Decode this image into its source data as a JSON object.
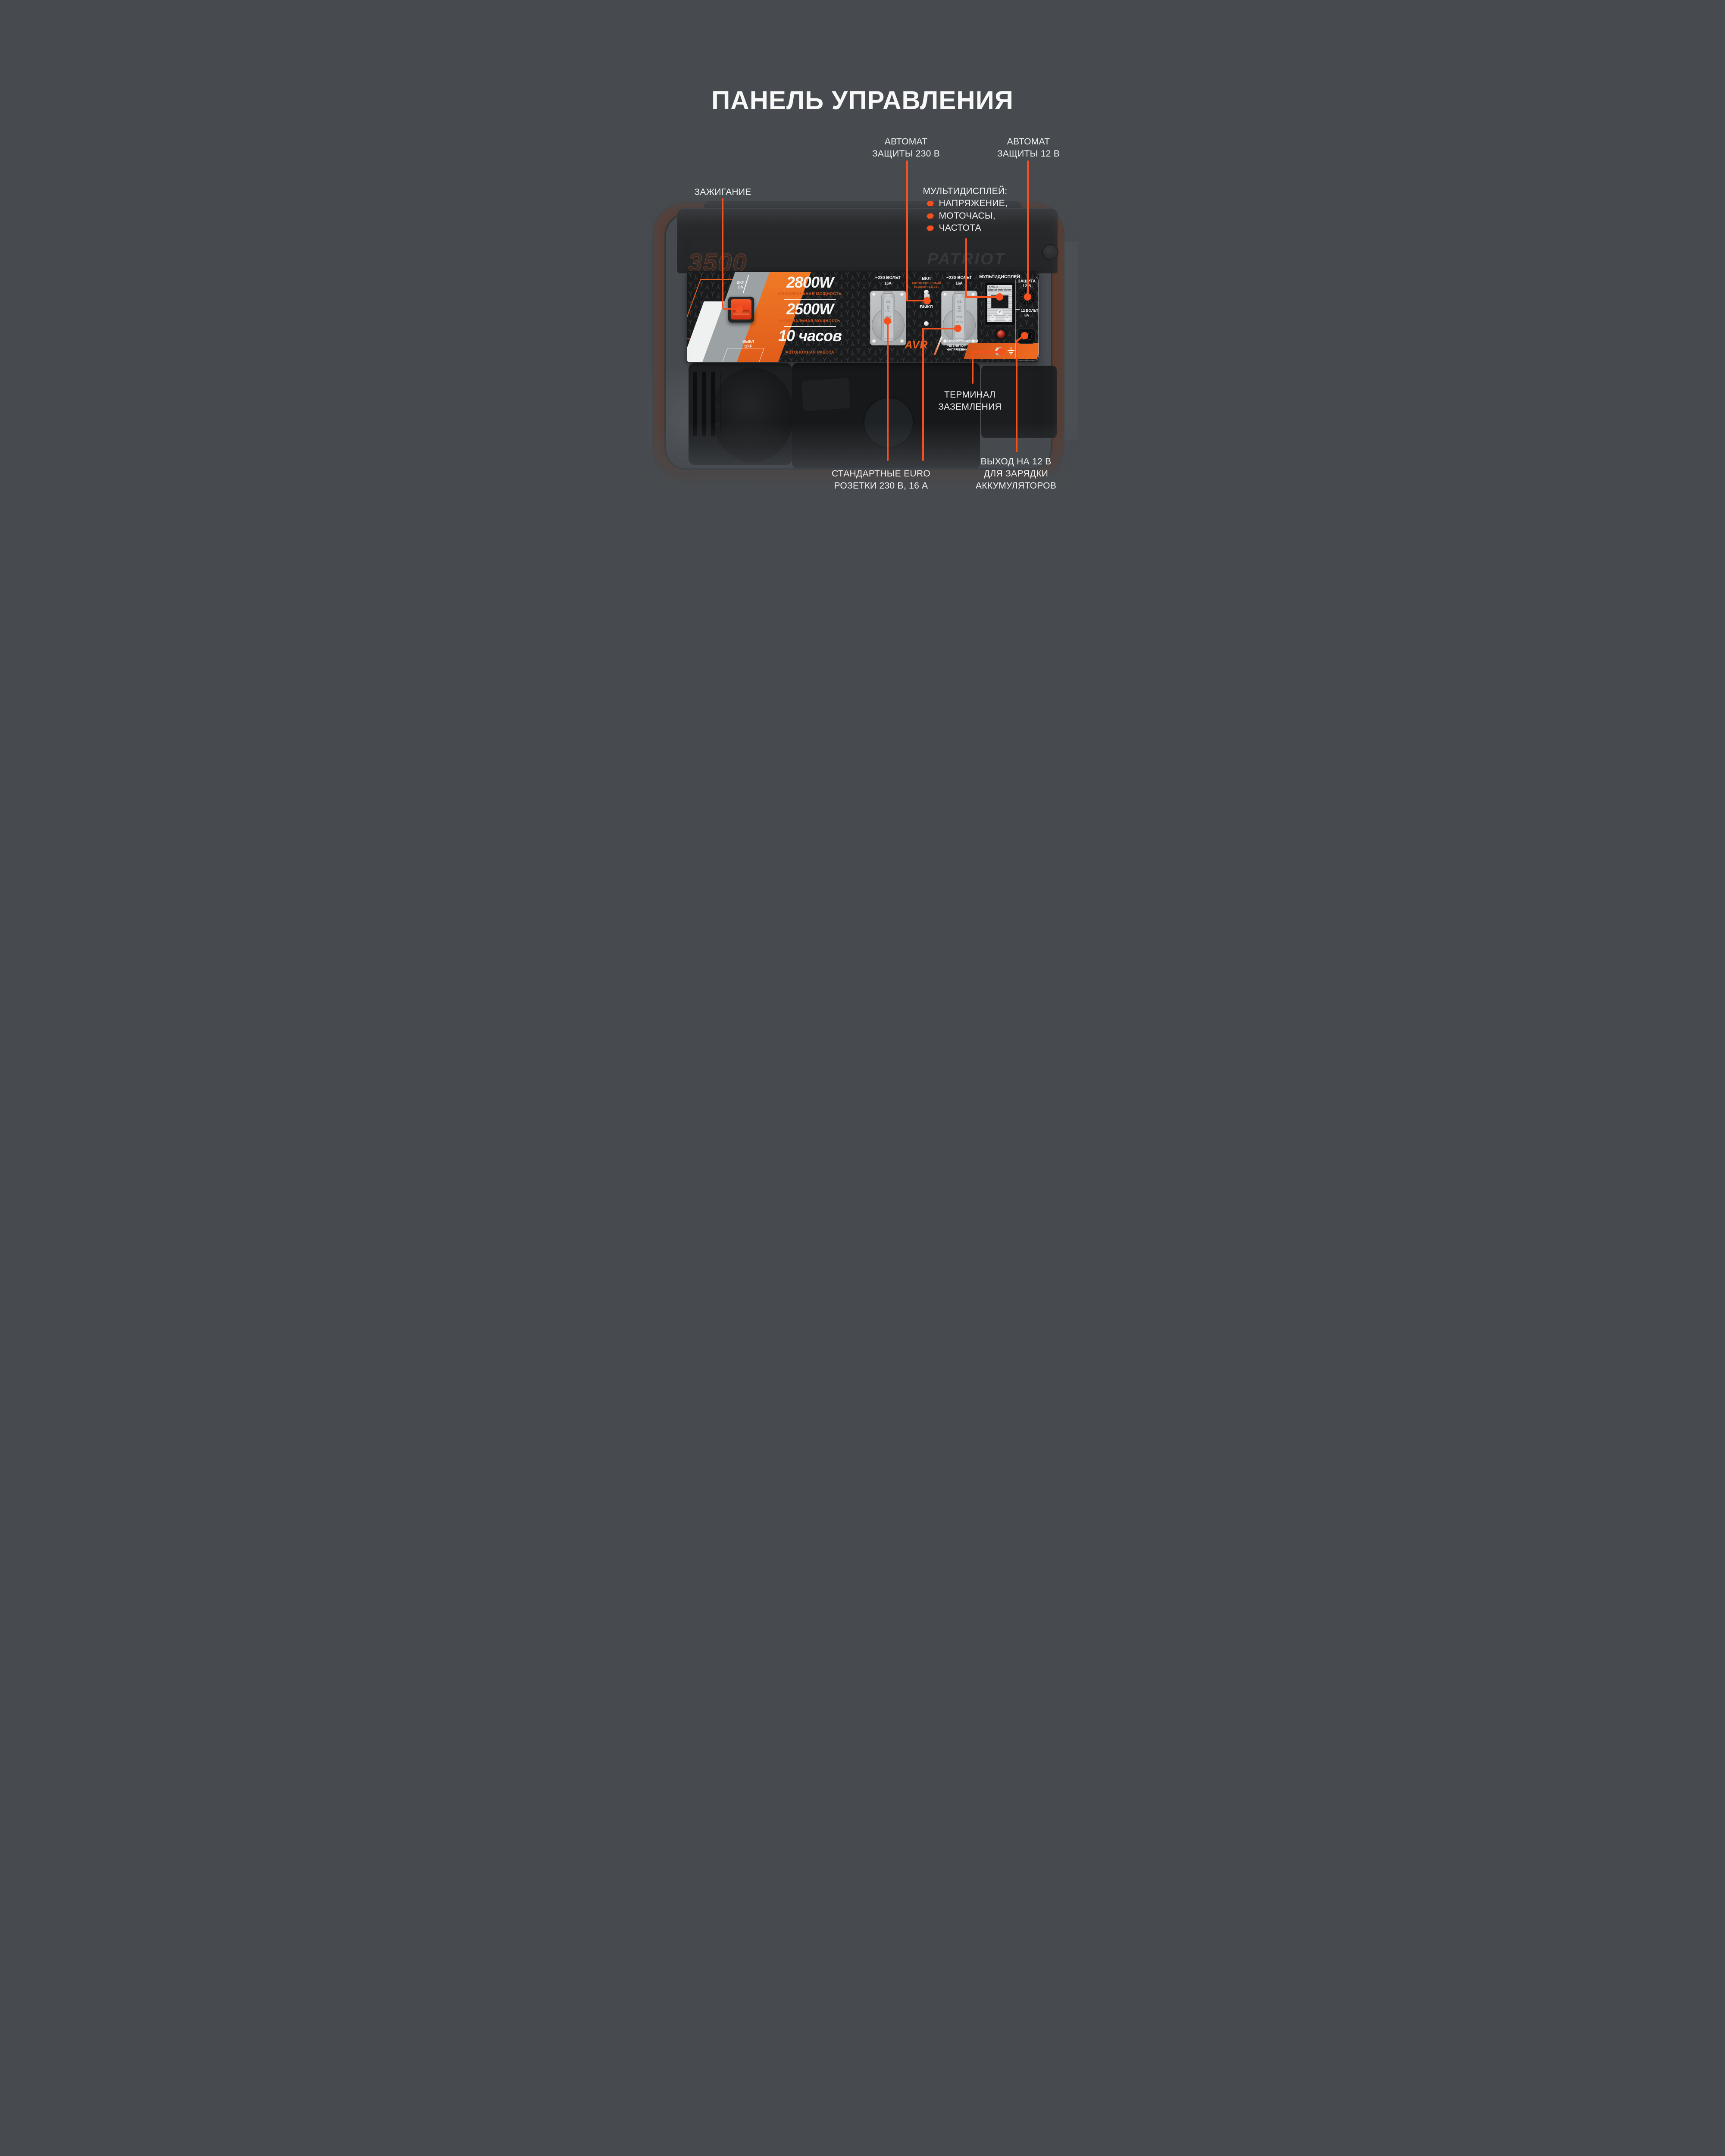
{
  "title": "ПАНЕЛЬ УПРАВЛЕНИЯ",
  "colors": {
    "background": "#474B4F",
    "accent": "#F4511E",
    "panel_orange": "#E8621F",
    "caption_orange": "#D4581E",
    "rocker_red": "#E8431F"
  },
  "callouts": {
    "breaker230": {
      "line1": "АВТОМАТ",
      "line2": "ЗАЩИТЫ 230 В"
    },
    "breaker12": {
      "line1": "АВТОМАТ",
      "line2": "ЗАЩИТЫ 12 В"
    },
    "ignition": {
      "line1": "ЗАЖИГАНИЕ"
    },
    "multidisplay": {
      "heading": "МУЛЬТИДИСПЛЕЙ:",
      "items": [
        "НАПРЯЖЕНИЕ,",
        "МОТОЧАСЫ,",
        "ЧАСТОТА"
      ]
    },
    "ground": {
      "line1": "ТЕРМИНАЛ",
      "line2": "ЗАЗЕМЛЕНИЯ"
    },
    "euro_sockets": {
      "line1": "СТАНДАРТНЫЕ EURO",
      "line2": "РОЗЕТКИ 230 В, 16 А"
    },
    "out12": {
      "line1": "ВЫХОД НА 12 В",
      "line2": "ДЛЯ ЗАРЯДКИ",
      "line3": "АККУМУЛЯТОРОВ"
    }
  },
  "generator": {
    "brand": "PATRIOT",
    "model": "3500"
  },
  "panel": {
    "ignition_switch": {
      "on_ru": "ВКЛ",
      "on_en": "ON",
      "off_ru": "ВЫКЛ",
      "off_en": "OFF"
    },
    "specs": {
      "max_value": "2800W",
      "max_label": "МАКСИМАЛЬНАЯ МОЩНОСТЬ",
      "nom_value": "2500W",
      "nom_label": "НОМИНАЛЬНАЯ МОЩНОСТЬ",
      "run_value": "10 часов",
      "run_label": "АВТОНОМНАЯ РАБОТА"
    },
    "socket": {
      "volts": "~230 ВОЛЬТ",
      "amps": "16А",
      "ce": "CE",
      "a": "16",
      "v": "250~",
      "ip": "IP44",
      "model": "J158-2"
    },
    "breaker_toggle": {
      "on": "ВКЛ",
      "auto1": "АВТОМАТИЧЕСКИЙ",
      "auto2": "ВЫКЛЮЧАТЕЛЬ",
      "off": "ВЫКЛ"
    },
    "avr": {
      "abbr": "AVR",
      "line1": "АВТОМАТИЧЕСКИЙ",
      "line2": "РЕГУЛЯТОР",
      "line3": "НАПРЯЖЕНИЯ"
    },
    "display": {
      "title": "МУЛЬТИДИСПЛЕЙ",
      "model": "KH01-3",
      "name": "Digital Volt Meter",
      "mode_v": "V",
      "mode_h": "H",
      "mode_hz": "Hz"
    },
    "protection12": {
      "line1": "ЗАЩИТА",
      "line2": "12 В"
    },
    "dc_out": {
      "line1": "12 ВОЛЬТ",
      "line2": "8А"
    }
  }
}
